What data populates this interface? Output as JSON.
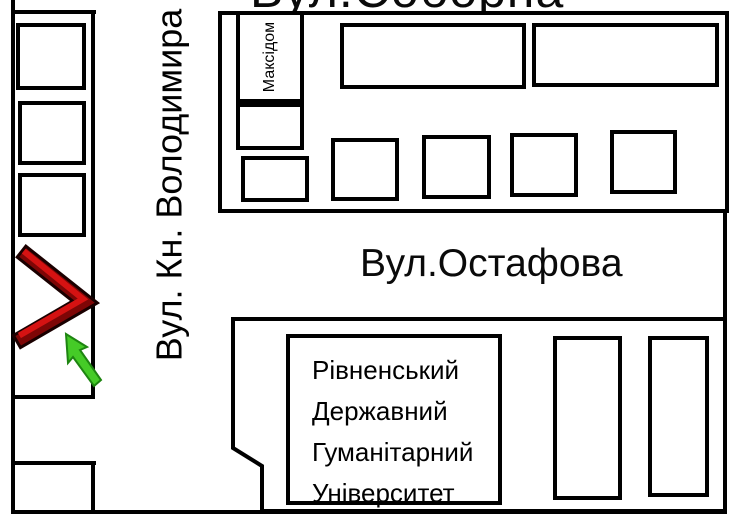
{
  "canvas": {
    "width": 735,
    "height": 530,
    "background": "#ffffff",
    "line_color": "#000000"
  },
  "streets": {
    "soborna": "Вул.Соборна",
    "volodymyra": "Вул. Кн. Володимира",
    "ostafova": "Вул.Остафова"
  },
  "buildings": {
    "maksidom": {
      "label": "Максідом"
    },
    "university": {
      "lines": [
        "Рівненський",
        "Державний",
        "Гуманітарний",
        "Університет"
      ]
    }
  },
  "markers": {
    "chevron": {
      "meaning": "destination-marker",
      "fill": "#d51212",
      "shade": "#7e0606",
      "outline": "#1a0000"
    },
    "arrow": {
      "meaning": "pointer-to-destination",
      "fill": "#45cb27",
      "outline": "#1e8511"
    }
  }
}
